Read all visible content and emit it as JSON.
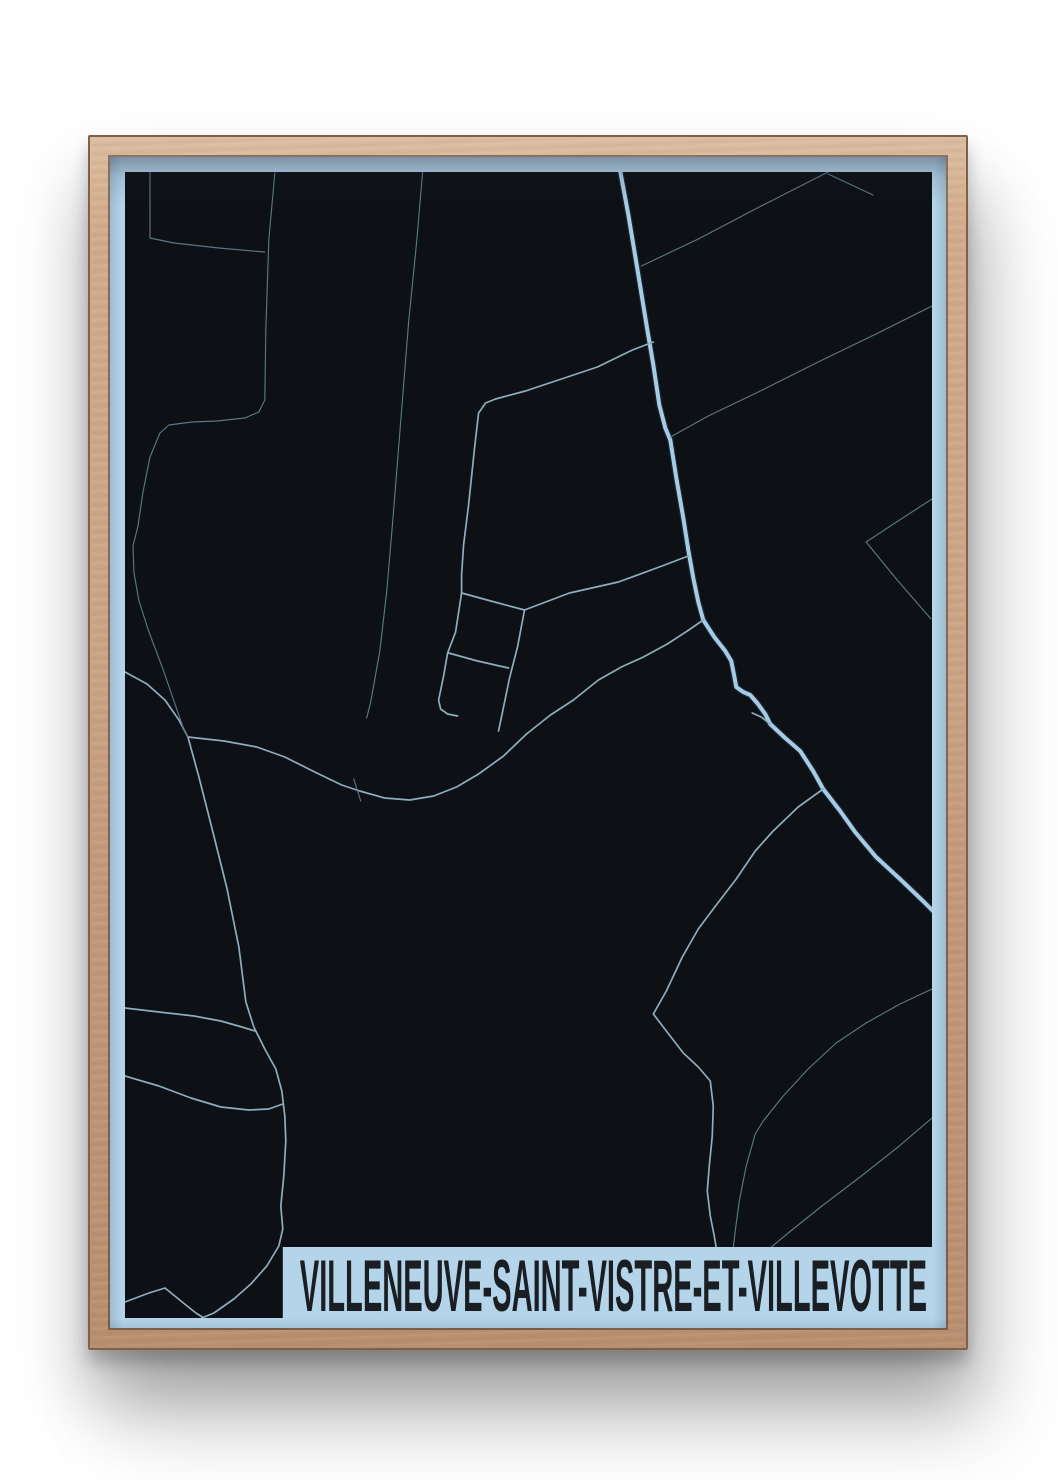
{
  "poster": {
    "title": "VILLENEUVE-SAINT-VISTRE-ET-VILLEVOTTE",
    "colors": {
      "map_bg": "#0d1014",
      "margin_blue": "#b4d4ea",
      "band_blue": "#b4d4ea",
      "title_text": "#1a1e23",
      "road_main": "#a6cbe5",
      "road_main_casing": "#1c2833",
      "road_minor": "#8fadbc",
      "road_faint": "#5b7785"
    },
    "roads": [
      {
        "id": "main-road",
        "class": "main",
        "points": [
          [
            623,
            172
          ],
          [
            631,
            215
          ],
          [
            641,
            275
          ],
          [
            650,
            330
          ],
          [
            656,
            365
          ],
          [
            662,
            405
          ],
          [
            668,
            428
          ],
          [
            673,
            440
          ],
          [
            679,
            478
          ],
          [
            686,
            518
          ],
          [
            691,
            550
          ],
          [
            696,
            578
          ],
          [
            701,
            602
          ],
          [
            706,
            620
          ],
          [
            717,
            637
          ],
          [
            728,
            651
          ],
          [
            734,
            661
          ],
          [
            737,
            676
          ],
          [
            739,
            687
          ],
          [
            746,
            692
          ],
          [
            753,
            695
          ],
          [
            760,
            703
          ],
          [
            768,
            714
          ],
          [
            773,
            724
          ],
          [
            788,
            738
          ],
          [
            803,
            751
          ],
          [
            816,
            771
          ],
          [
            826,
            789
          ],
          [
            843,
            811
          ],
          [
            858,
            832
          ],
          [
            879,
            857
          ],
          [
            904,
            880
          ],
          [
            927,
            902
          ],
          [
            936,
            911
          ]
        ]
      },
      {
        "id": "main-spur",
        "class": "minor",
        "points": [
          [
            755,
            713
          ],
          [
            764,
            717
          ],
          [
            773,
            724
          ]
        ]
      },
      {
        "id": "village-main-street",
        "class": "minor",
        "points": [
          [
            656,
            342
          ],
          [
            635,
            350
          ],
          [
            600,
            367
          ],
          [
            558,
            381
          ],
          [
            528,
            391
          ],
          [
            498,
            399
          ],
          [
            488,
            403
          ],
          [
            481,
            413
          ],
          [
            477,
            448
          ],
          [
            471,
            505
          ],
          [
            466,
            545
          ],
          [
            464,
            575
          ],
          [
            464,
            593
          ],
          [
            458,
            632
          ],
          [
            450,
            653
          ],
          [
            446,
            676
          ],
          [
            441,
            700
          ],
          [
            443,
            709
          ],
          [
            450,
            714
          ],
          [
            460,
            716
          ]
        ]
      },
      {
        "id": "village-cross-1",
        "class": "minor",
        "points": [
          [
            464,
            593
          ],
          [
            497,
            602
          ],
          [
            527,
            610
          ]
        ]
      },
      {
        "id": "village-street-2",
        "class": "minor",
        "points": [
          [
            527,
            610
          ],
          [
            520,
            647
          ],
          [
            512,
            678
          ],
          [
            505,
            712
          ],
          [
            501,
            731
          ]
        ]
      },
      {
        "id": "village-cross-2",
        "class": "minor",
        "points": [
          [
            451,
            653
          ],
          [
            480,
            661
          ],
          [
            511,
            668
          ]
        ]
      },
      {
        "id": "village-ne-link",
        "class": "minor",
        "points": [
          [
            527,
            610
          ],
          [
            572,
            593
          ],
          [
            621,
            582
          ],
          [
            662,
            567
          ],
          [
            691,
            556
          ]
        ]
      },
      {
        "id": "wavy-east-west",
        "class": "minor",
        "points": [
          [
            190,
            737
          ],
          [
            226,
            741
          ],
          [
            259,
            747
          ],
          [
            287,
            757
          ],
          [
            317,
            772
          ],
          [
            344,
            785
          ],
          [
            362,
            791
          ],
          [
            387,
            798
          ],
          [
            412,
            800
          ],
          [
            436,
            796
          ],
          [
            459,
            787
          ],
          [
            481,
            774
          ],
          [
            506,
            756
          ],
          [
            529,
            734
          ],
          [
            553,
            715
          ],
          [
            576,
            700
          ],
          [
            601,
            680
          ],
          [
            624,
            667
          ],
          [
            646,
            657
          ],
          [
            670,
            644
          ],
          [
            690,
            631
          ],
          [
            706,
            620
          ]
        ]
      },
      {
        "id": "wavy-tick",
        "class": "faint",
        "points": [
          [
            356,
            779
          ],
          [
            363,
            801
          ]
        ]
      },
      {
        "id": "south-road",
        "class": "minor",
        "points": [
          [
            190,
            737
          ],
          [
            201,
            777
          ],
          [
            215,
            832
          ],
          [
            229,
            888
          ],
          [
            241,
            947
          ],
          [
            248,
            1002
          ],
          [
            256,
            1027
          ],
          [
            267,
            1049
          ],
          [
            278,
            1069
          ],
          [
            284,
            1091
          ],
          [
            287,
            1116
          ],
          [
            288,
            1141
          ],
          [
            286,
            1176
          ],
          [
            283,
            1206
          ],
          [
            285,
            1229
          ],
          [
            281,
            1246
          ],
          [
            269,
            1266
          ],
          [
            253,
            1284
          ],
          [
            236,
            1299
          ],
          [
            216,
            1313
          ],
          [
            204,
            1318
          ]
        ]
      },
      {
        "id": "southwest-link-1",
        "class": "minor",
        "points": [
          [
            127,
            1008
          ],
          [
            161,
            1012
          ],
          [
            196,
            1016
          ],
          [
            223,
            1021
          ],
          [
            244,
            1027
          ],
          [
            257,
            1031
          ]
        ]
      },
      {
        "id": "southwest-link-2",
        "class": "minor",
        "points": [
          [
            127,
            1076
          ],
          [
            161,
            1086
          ],
          [
            193,
            1098
          ],
          [
            223,
            1107
          ],
          [
            251,
            1110
          ],
          [
            271,
            1109
          ],
          [
            285,
            1104
          ]
        ]
      },
      {
        "id": "west-link",
        "class": "minor",
        "points": [
          [
            127,
            672
          ],
          [
            149,
            684
          ],
          [
            167,
            700
          ],
          [
            181,
            720
          ],
          [
            190,
            737
          ]
        ]
      },
      {
        "id": "west-boundary",
        "class": "faint",
        "points": [
          [
            277,
            173
          ],
          [
            271,
            240
          ],
          [
            268,
            330
          ],
          [
            267,
            400
          ],
          [
            261,
            412
          ],
          [
            247,
            418
          ],
          [
            219,
            421
          ],
          [
            194,
            422
          ],
          [
            171,
            425
          ],
          [
            162,
            433
          ],
          [
            152,
            457
          ],
          [
            145,
            492
          ],
          [
            140,
            526
          ],
          [
            135,
            546
          ],
          [
            136,
            573
          ],
          [
            141,
            601
          ],
          [
            151,
            632
          ],
          [
            165,
            669
          ],
          [
            176,
            701
          ],
          [
            185,
            727
          ],
          [
            190,
            737
          ]
        ]
      },
      {
        "id": "northwest-corner",
        "class": "faint",
        "points": [
          [
            152,
            172
          ],
          [
            152,
            238
          ],
          [
            176,
            243
          ],
          [
            221,
            248
          ],
          [
            267,
            252
          ]
        ]
      },
      {
        "id": "north-field-line",
        "class": "faint",
        "points": [
          [
            425,
            172
          ],
          [
            419,
            242
          ],
          [
            411,
            322
          ],
          [
            403,
            422
          ],
          [
            395,
            522
          ],
          [
            389,
            592
          ],
          [
            382,
            652
          ],
          [
            373,
            702
          ],
          [
            369,
            718
          ]
        ]
      },
      {
        "id": "northeast-diagonal",
        "class": "faint",
        "points": [
          [
            831,
            172
          ],
          [
            762,
            207
          ],
          [
            701,
            239
          ],
          [
            644,
            266
          ]
        ]
      },
      {
        "id": "northeast-stub",
        "class": "faint",
        "points": [
          [
            831,
            174
          ],
          [
            861,
            188
          ],
          [
            876,
            195
          ]
        ]
      },
      {
        "id": "east-diagonal",
        "class": "faint",
        "points": [
          [
            935,
            306
          ],
          [
            881,
            333
          ],
          [
            821,
            362
          ],
          [
            761,
            392
          ],
          [
            711,
            416
          ],
          [
            673,
            437
          ]
        ]
      },
      {
        "id": "east-v-upper",
        "class": "faint",
        "points": [
          [
            935,
            499
          ],
          [
            901,
            521
          ],
          [
            869,
            542
          ]
        ]
      },
      {
        "id": "east-v-lower",
        "class": "faint",
        "points": [
          [
            869,
            542
          ],
          [
            901,
            581
          ],
          [
            934,
            619
          ]
        ]
      },
      {
        "id": "southeast-road",
        "class": "minor",
        "points": [
          [
            826,
            789
          ],
          [
            801,
            807
          ],
          [
            776,
            831
          ],
          [
            758,
            851
          ],
          [
            739,
            879
          ],
          [
            719,
            905
          ],
          [
            701,
            929
          ],
          [
            685,
            957
          ],
          [
            669,
            991
          ],
          [
            656,
            1014
          ],
          [
            669,
            1031
          ],
          [
            686,
            1053
          ],
          [
            701,
            1067
          ],
          [
            713,
            1081
          ],
          [
            716,
            1106
          ],
          [
            715,
            1136
          ],
          [
            712,
            1166
          ],
          [
            710,
            1191
          ],
          [
            713,
            1216
          ],
          [
            717,
            1236
          ],
          [
            719,
            1248
          ]
        ]
      },
      {
        "id": "southeast-diagonal-1",
        "class": "faint",
        "points": [
          [
            935,
            989
          ],
          [
            903,
            1004
          ],
          [
            869,
            1023
          ],
          [
            839,
            1043
          ],
          [
            811,
            1069
          ],
          [
            786,
            1096
          ],
          [
            766,
            1121
          ],
          [
            758,
            1134
          ],
          [
            749,
            1166
          ],
          [
            742,
            1201
          ],
          [
            738,
            1231
          ],
          [
            736,
            1248
          ]
        ]
      },
      {
        "id": "southeast-diagonal-2",
        "class": "faint",
        "points": [
          [
            935,
            1118
          ],
          [
            901,
            1147
          ],
          [
            863,
            1177
          ],
          [
            826,
            1205
          ],
          [
            791,
            1233
          ],
          [
            773,
            1248
          ]
        ]
      },
      {
        "id": "southwest-zigzag",
        "class": "minor",
        "points": [
          [
            127,
            1302
          ],
          [
            151,
            1293
          ],
          [
            167,
            1288
          ],
          [
            183,
            1301
          ],
          [
            198,
            1313
          ],
          [
            206,
            1318
          ]
        ]
      }
    ]
  }
}
